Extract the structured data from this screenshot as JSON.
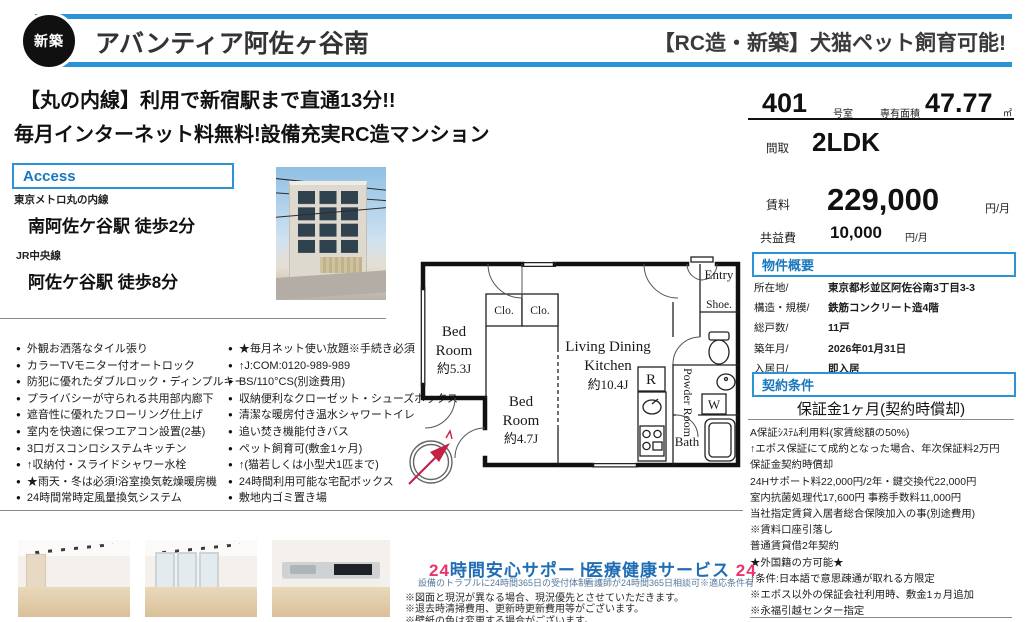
{
  "header": {
    "badge": "新築",
    "title": "アバンティア阿佐ヶ谷南",
    "right_title": "【RC造・新築】犬猫ペット飼育可能!"
  },
  "catch": {
    "line1": "【丸の内線】利用で新宿駅まで直通13分!!",
    "line2": "毎月インターネット料無料!設備充実RC造マンション"
  },
  "access": {
    "heading": "Access",
    "routes": [
      {
        "line": "東京メトロ丸の内線",
        "station": "南阿佐ケ谷駅 徒歩2分"
      },
      {
        "line": "JR中央線",
        "station": "阿佐ケ谷駅 徒歩8分"
      }
    ]
  },
  "features": {
    "left": [
      "外観お洒落なタイル張り",
      "カラーTVモニター付オートロック",
      "防犯に優れたダブルロック・ディンプルキー",
      "プライバシーが守られる共用部内廊下",
      "遮音性に優れたフローリング仕上げ",
      "室内を快適に保つエアコン設置(2基)",
      "3口ガスコンロシステムキッチン",
      "↑収納付・スライドシャワー水栓",
      "★雨天・冬は必須!浴室換気乾燥暖房機",
      "24時間常時定風量換気システム"
    ],
    "right": [
      "★毎月ネット使い放題※手続き必須",
      "↑J:COM:0120-989-989",
      "BS/110°CS(別途費用)",
      "収納便利なクローゼット・シューズボックス",
      "清潔な暖房付き温水シャワートイレ",
      "追い焚き機能付きバス",
      "ペット飼育可(敷金1ヶ月)",
      "↑(猫若しくは小型犬1匹まで)",
      "24時間利用可能な宅配ボックス",
      "敷地内ゴミ置き場"
    ]
  },
  "floorplan": {
    "bed1_l1": "Bed",
    "bed1_l2": "Room",
    "bed1_size": "約5.3J",
    "bed2_l1": "Bed",
    "bed2_l2": "Room",
    "bed2_size": "約4.7J",
    "ldk_l1": "Living Dining",
    "ldk_l2": "Kitchen",
    "ldk_size": "約10.4J",
    "clo1": "Clo.",
    "clo2": "Clo.",
    "fridge": "R",
    "entry": "Entry",
    "shoe": "Shoe.",
    "powder": "Powder Room",
    "washer": "W",
    "bath": "Bath"
  },
  "unit": {
    "room_number": "401",
    "room_number_suffix": "号室",
    "area_label": "専有面積",
    "area_value": "47.77",
    "area_unit": "㎡",
    "layout_label": "間取",
    "layout": "2LDK",
    "rent_label": "賃料",
    "rent": "229,000",
    "rent_unit": "円/月",
    "fee_label": "共益費",
    "fee": "10,000",
    "fee_unit": "円/月"
  },
  "overview": {
    "heading": "物件概要",
    "rows": [
      {
        "label": "所在地/",
        "value": "東京都杉並区阿佐谷南3丁目3-3"
      },
      {
        "label": "構造・規模/",
        "value": "鉄筋コンクリート造4階"
      },
      {
        "label": "総戸数/",
        "value": "11戸"
      },
      {
        "label": "築年月/",
        "value": "2026年01月31日"
      },
      {
        "label": "入居日/",
        "value": "即入居"
      }
    ]
  },
  "contract": {
    "heading": "契約条件",
    "highlight": "保証金1ヶ月(契約時償却)",
    "details": [
      "A保証ｼｽﾃﾑ利用料(家賃総額の50%)",
      "↑エポス保証にて成約となった場合、年次保証料2万円",
      "保証金契約時償却",
      "24Hサポート料22,000円/2年・鍵交換代22,000円",
      "室内抗菌処理代17,600円 事務手数料11,000円",
      "当社指定賃貸入居者総合保険加入の事(別途費用)",
      "※賃料口座引落し",
      "普通賃貸借2年契約",
      "★外国籍の方可能★",
      "↑条件:日本語で意思疎通が取れる方限定",
      "※エポス以外の保証会社利用時、敷金1ヵ月追加",
      "※永福引越センター指定"
    ]
  },
  "services": {
    "s1_num": "24",
    "s1_text": "時間安心サポート",
    "s1_caption": "設備のトラブルに24時間365日の受付体制",
    "s2_text": "医療健康サービス ",
    "s2_num": "24",
    "s2_caption": "看護師が24時間365日相談可※適応条件有"
  },
  "notes": [
    "※図面と現況が異なる場合、現況優先とさせていただきます。",
    "※退去時清掃費用、更新時更新費用等がございます。",
    "※壁紙の色は変更する場合がございます。"
  ],
  "colors": {
    "accent_blue": "#2b94d8",
    "heading_blue": "#1878be",
    "pink": "#e9336b",
    "service_blue": "#1f6eb5"
  }
}
